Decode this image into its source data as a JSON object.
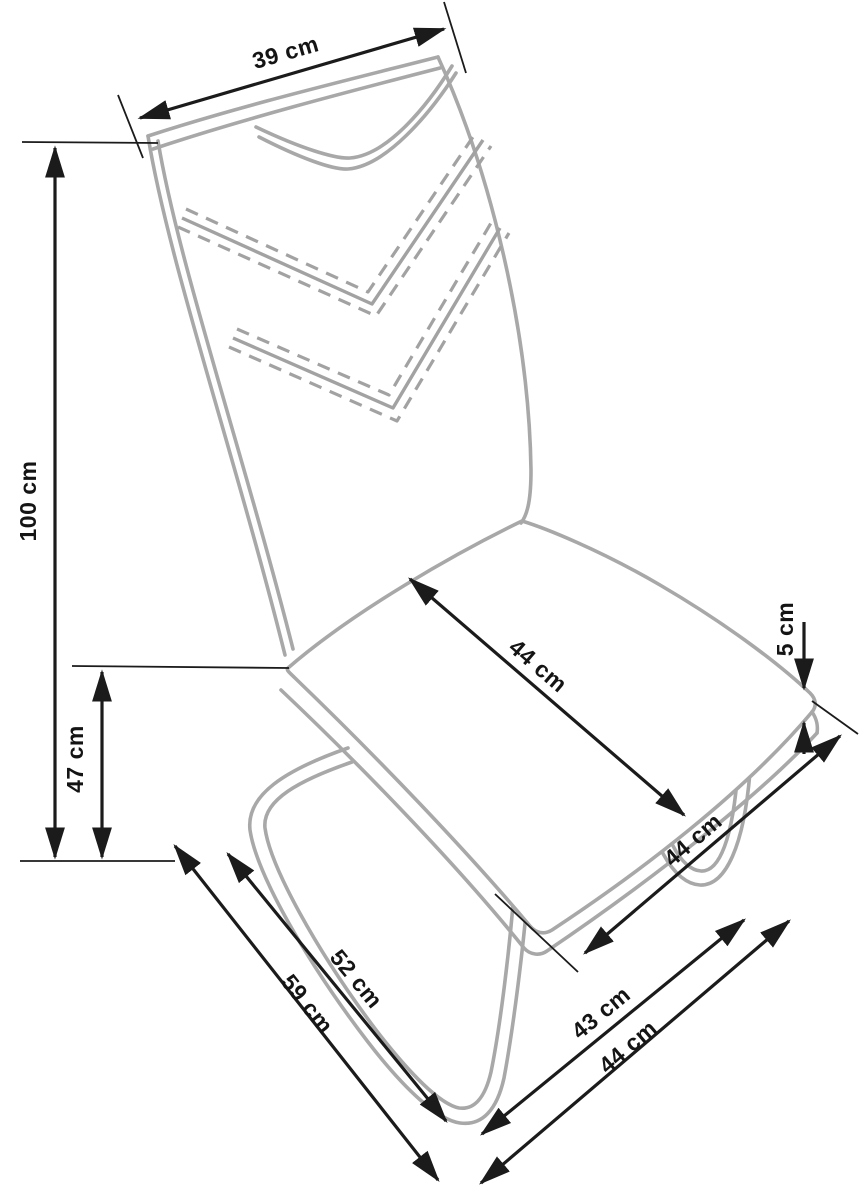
{
  "diagram": {
    "subject": "chair dimension drawing",
    "unit": "cm",
    "colors": {
      "dimension_line": "#1b1b1b",
      "chair_outline": "#a8a8a8",
      "background": "#ffffff"
    },
    "dimensions": [
      {
        "id": "backrest-top-width",
        "label": "39 cm",
        "value": 39
      },
      {
        "id": "total-height",
        "label": "100 cm",
        "value": 100
      },
      {
        "id": "seat-height",
        "label": "47 cm",
        "value": 47
      },
      {
        "id": "seat-diagonal-top",
        "label": "44 cm",
        "value": 44
      },
      {
        "id": "seat-edge-thickness",
        "label": "5 cm",
        "value": 5
      },
      {
        "id": "seat-depth-side",
        "label": "44 cm",
        "value": 44
      },
      {
        "id": "base-front-rail",
        "label": "52 cm",
        "value": 52
      },
      {
        "id": "base-left-depth",
        "label": "59 cm",
        "value": 59
      },
      {
        "id": "base-side-rail",
        "label": "43 cm",
        "value": 43
      },
      {
        "id": "base-right-depth",
        "label": "44 cm",
        "value": 44
      }
    ]
  }
}
